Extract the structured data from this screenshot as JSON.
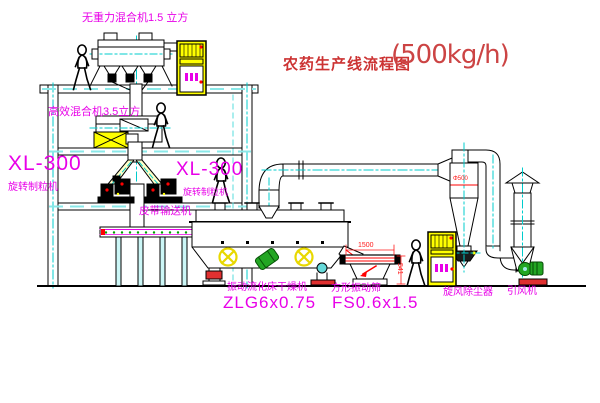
{
  "title": {
    "text": "农药生产线流程图",
    "capacity": "(500kg/h)"
  },
  "equipment_labels": {
    "top_mixer": "无重力混合机1.5 立方",
    "mid_mixer": "高效混合机3.5立方",
    "granulator_left": {
      "model": "XL-300",
      "name": "旋转制粒机"
    },
    "granulator_right": {
      "model": "XL-300",
      "name": "旋转制粒机"
    },
    "belt_conveyor": "皮带输送机",
    "dryer": {
      "name": "振动流化床干燥机",
      "model": "ZLG6x0.75"
    },
    "sieve": {
      "name": "方形振动筛",
      "model": "FS0.6x1.5"
    },
    "dust_collector": "旋风除尘器",
    "induced_draft_fan": "引风机"
  },
  "dimensions": {
    "sieve_length": "1500",
    "sieve_height": "541",
    "cyclone_diameter": "Φ500"
  },
  "colors": {
    "label_magenta": "#e800e8",
    "title_red": "#cc3333",
    "line_black": "#000000",
    "centerline_cyan": "#00cccc",
    "cabinet_yellow": "#ffff00",
    "accent_red": "#ff0000",
    "accent_green": "#00a000"
  }
}
